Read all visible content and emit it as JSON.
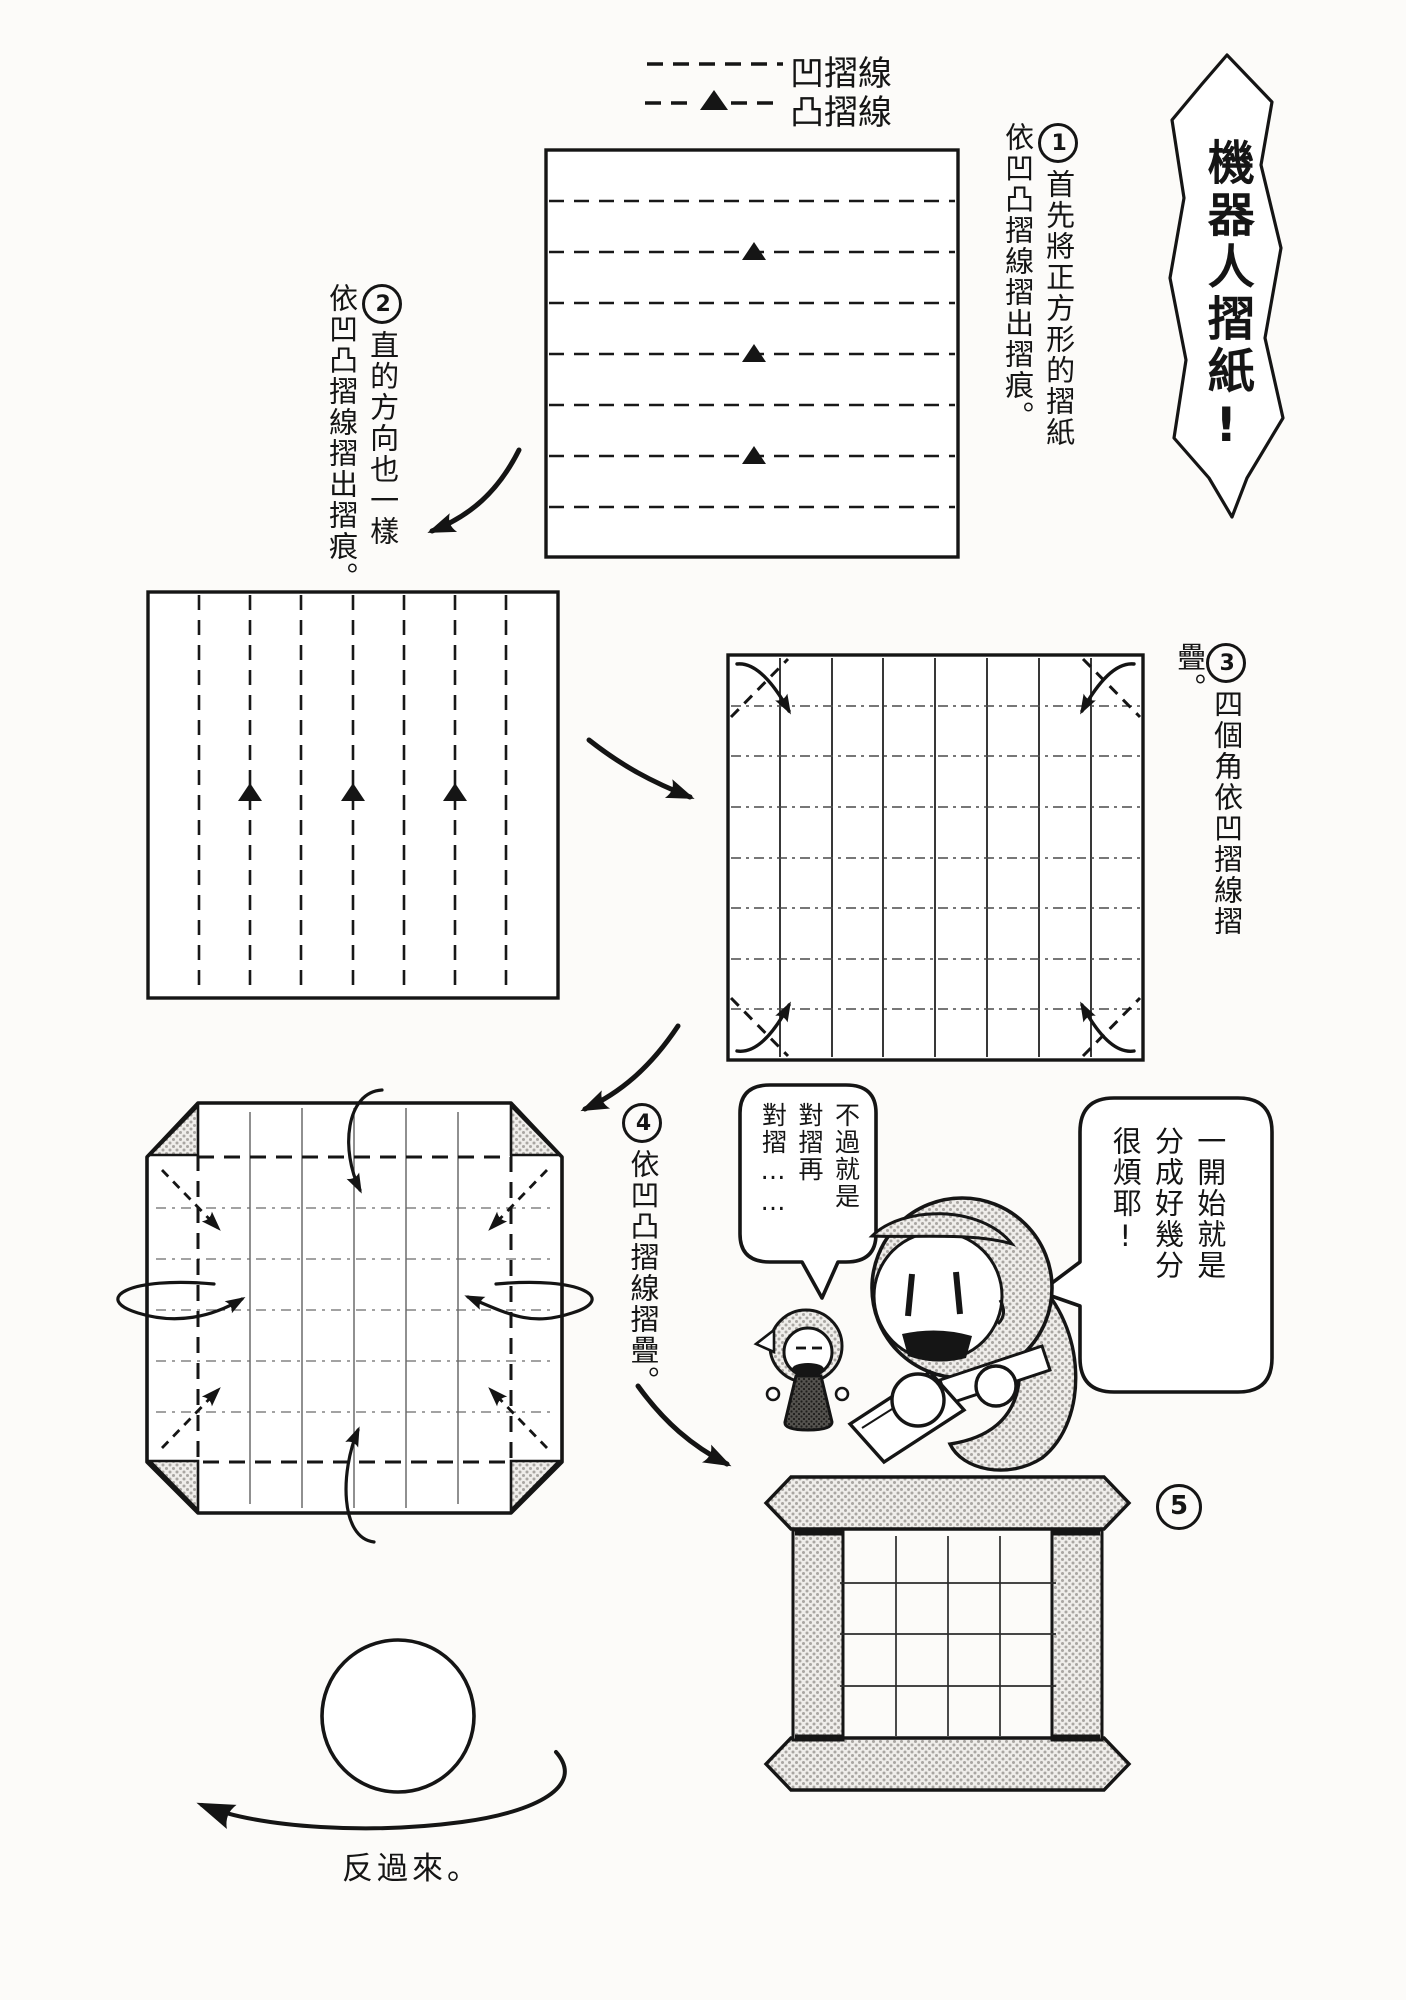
{
  "page": {
    "background_color": "#fcfbf9",
    "ink_color": "#151515",
    "tone_color": "#a9a6a2"
  },
  "legend": {
    "valley_fold": {
      "label": "凹摺線",
      "symbol": "dashed-line"
    },
    "mountain_fold": {
      "label": "凸摺線",
      "symbol": "dashed-line-with-triangle"
    }
  },
  "title_banner": {
    "text": "機器人摺紙!"
  },
  "steps": {
    "step1": {
      "number": "1",
      "caption_col1": "首先將正方形的摺紙",
      "caption_col2": "依凹凸摺線摺出摺痕。"
    },
    "step2": {
      "number": "2",
      "caption_col1": "直的方向也一樣",
      "caption_col2": "依凹凸摺線摺出摺痕。"
    },
    "step3": {
      "number": "3",
      "caption": "四個角依凹摺線摺疊。"
    },
    "step4": {
      "number": "4",
      "caption": "依凹凸摺線摺疊。"
    },
    "step5": {
      "number": "5"
    }
  },
  "speech_bubbles": {
    "small_robot": {
      "col1": "不過就是",
      "col2": "對摺再",
      "col3": "對摺……"
    },
    "big_robot": {
      "col1": "一開始就是",
      "col2": "分成好幾分",
      "col3": "很煩耶!"
    }
  },
  "footer": {
    "flip_instruction": "反過來。"
  }
}
